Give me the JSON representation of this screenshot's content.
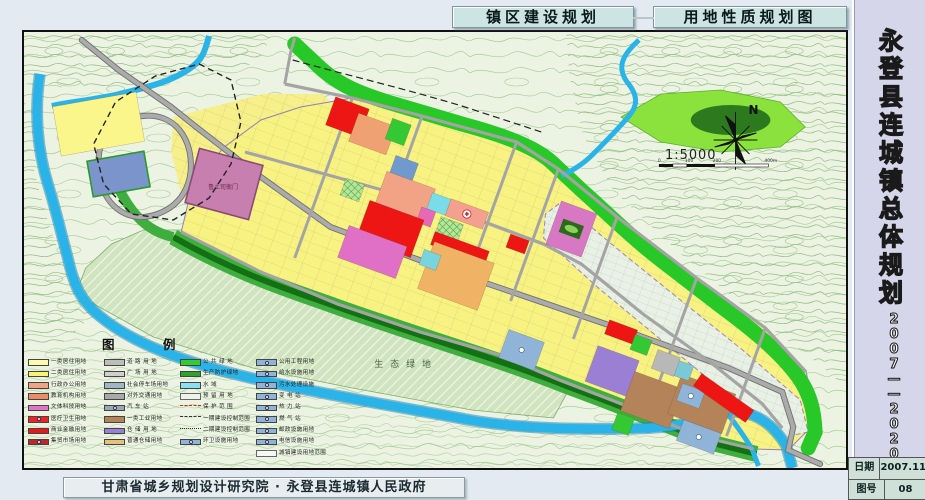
{
  "titles": {
    "construction": "镇区建设规划",
    "landuse": "用地性质规划图"
  },
  "sidebar": {
    "project_title": "永登县连城镇总体规划",
    "period": "2007——2020",
    "date_label": "日期",
    "date_value": "2007.11",
    "sheet_label": "图号",
    "sheet_value": "08"
  },
  "credit": "甘肃省城乡规划设计研究院 · 永登县连城镇人民政府",
  "map": {
    "north_label": "N",
    "scale_text": "1:5000",
    "scale_ticks": [
      "0",
      "100",
      "200",
      "400m"
    ],
    "eco_label": "生态绿地",
    "heritage_label": "鲁土司衙门"
  },
  "colors": {
    "residential_1": "#fdfcae",
    "residential_2": "#fbf272",
    "admin_office": "#f2a285",
    "education": "#ec8d66",
    "culture_sport": "#e273c8",
    "medical": "#ee2222",
    "commercial": "#ee1515",
    "market": "#c32525",
    "industry_1": "#b5835a",
    "warehouse": "#9b7fd4",
    "public_green": "#33cc33",
    "protective_green": "#2da32d",
    "water": "#29b3e8",
    "utility_blue": "#8fb4d8"
  },
  "legend": {
    "title": "图 例",
    "columns": [
      [
        {
          "label": "一类居住用地",
          "type": "fill",
          "color": "#fdfcae"
        },
        {
          "label": "二类居住用地",
          "type": "fill",
          "color": "#fbf272"
        },
        {
          "label": "行政办公用地",
          "type": "fill",
          "color": "#f2a285"
        },
        {
          "label": "教育机构用地",
          "type": "fill",
          "color": "#ec8d66"
        },
        {
          "label": "文体科技用地",
          "type": "fill",
          "color": "#e273c8"
        },
        {
          "label": "医疗卫生用地",
          "type": "icon",
          "color": "#ee2222"
        },
        {
          "label": "商业金融用地",
          "type": "fill",
          "color": "#ee1515"
        },
        {
          "label": "集贸市场用地",
          "type": "icon",
          "color": "#c32525"
        }
      ],
      [
        {
          "label": "道 路 用 地",
          "type": "fill",
          "color": "#bdbdbd"
        },
        {
          "label": "广 场 用 地",
          "type": "fill",
          "color": "#cfcfcf"
        },
        {
          "label": "社会停车场用地",
          "type": "fill",
          "color": "#9fb6c8"
        },
        {
          "label": "对外交通用地",
          "type": "fill",
          "color": "#a9a9a9"
        },
        {
          "label": "汽 车 站",
          "type": "icon",
          "color": "#98a8b6"
        },
        {
          "label": "一类工业用地",
          "type": "fill",
          "color": "#b5835a"
        },
        {
          "label": "仓 储 用 地",
          "type": "fill",
          "color": "#9b7fd4"
        },
        {
          "label": "普通仓储用地",
          "type": "fill",
          "color": "#e8c07e"
        }
      ],
      [
        {
          "label": "公 共 绿 地",
          "type": "fill",
          "color": "#33cc33"
        },
        {
          "label": "生产防护绿地",
          "type": "fill",
          "color": "#2da32d"
        },
        {
          "label": "水  域",
          "type": "fill",
          "color": "#8ae0f0"
        },
        {
          "label": "预 留 用 地",
          "type": "outline",
          "color": "#eef3ea"
        },
        {
          "label": "保 护 范 围",
          "type": "line-red-dash",
          "color": "#dd2222"
        },
        {
          "label": "一期建设控制范围",
          "type": "line-dash",
          "color": "#333333"
        },
        {
          "label": "二期建设控制范围",
          "type": "line-dashdot",
          "color": "#333333"
        },
        {
          "label": "环卫设施用地",
          "type": "icon",
          "color": "#8fb4d8"
        }
      ],
      [
        {
          "label": "公用工程用地",
          "type": "icon",
          "color": "#8fb4d8"
        },
        {
          "label": "给水设施用地",
          "type": "icon",
          "color": "#8fb4d8"
        },
        {
          "label": "污水处理设施",
          "type": "icon",
          "color": "#8fb4d8"
        },
        {
          "label": "变 电 站",
          "type": "icon",
          "color": "#8fb4d8"
        },
        {
          "label": "热 力 站",
          "type": "icon",
          "color": "#8fb4d8"
        },
        {
          "label": "燃 气 站",
          "type": "icon",
          "color": "#8fb4d8"
        },
        {
          "label": "邮政设施用地",
          "type": "icon",
          "color": "#8fb4d8"
        },
        {
          "label": "电信设施用地",
          "type": "icon",
          "color": "#8fb4d8"
        },
        {
          "label": "城镇建设用地范围",
          "type": "outline",
          "color": "#f4f7f2"
        }
      ]
    ]
  }
}
